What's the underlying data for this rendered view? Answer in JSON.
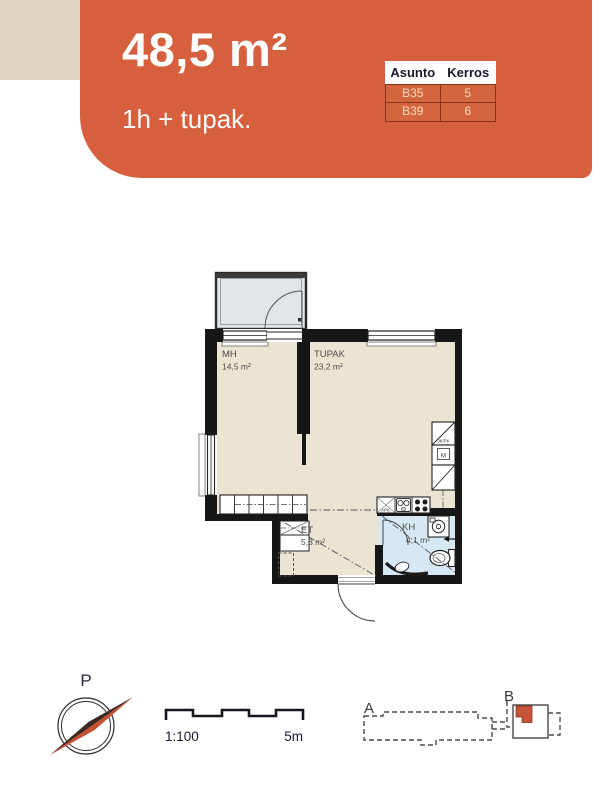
{
  "header": {
    "area_title": "48,5 m²",
    "type_subtitle": "1h + tupak.",
    "table": {
      "columns": [
        "Asunto",
        "Kerros"
      ],
      "rows": [
        [
          "B35",
          "5"
        ],
        [
          "B39",
          "6"
        ]
      ]
    }
  },
  "floorplan": {
    "rooms": [
      {
        "name": "MH",
        "area": "14,5 m²"
      },
      {
        "name": "TUPAK",
        "area": "23,2 m²"
      },
      {
        "name": "ET",
        "area": "5,8 m²"
      },
      {
        "name": "KH",
        "area": "4,1 m²"
      }
    ],
    "appliances": {
      "fridge_freezer": "JK/PK",
      "microwave": "M",
      "dishwasher": "APK"
    }
  },
  "footer": {
    "compass_label": "P",
    "scale_ratio": "1:100",
    "scale_length": "5m",
    "site_buildings": [
      {
        "label": "A"
      },
      {
        "label": "B"
      }
    ]
  },
  "colors": {
    "accent_orange": "#d6603e",
    "corner_beige": "#ddd5c1",
    "floor_cream": "#ece4d3",
    "bathroom_blue": "#d7e8f5",
    "balcony_grey": "#e0e6e9",
    "wall_black": "#161616",
    "table_border": "#8c311c"
  }
}
